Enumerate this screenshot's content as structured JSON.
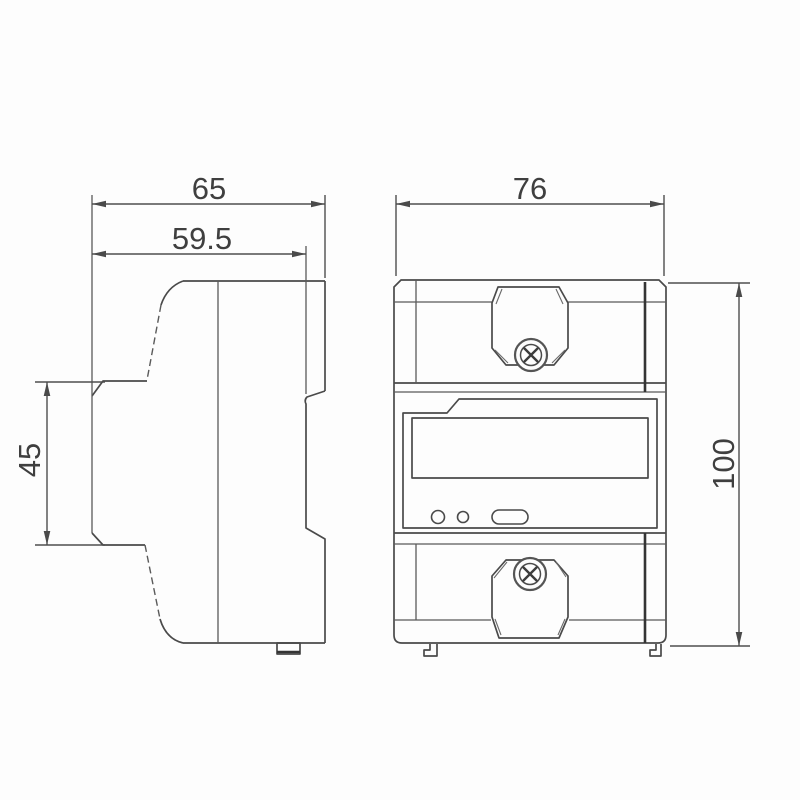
{
  "page": {
    "background_color": "#fdfdfd",
    "line_color": "#4a4a4a",
    "text_color": "#3f3f3f"
  },
  "drawing": {
    "type": "technical-dimension-drawing",
    "views": {
      "side_view": "side-profile-of-din-rail-meter",
      "front_view": "front-of-din-rail-meter"
    },
    "dimensions": {
      "side_total_depth": "65",
      "side_body_depth": "59.5",
      "side_front_height": "45",
      "front_width": "76",
      "front_height": "100"
    }
  }
}
